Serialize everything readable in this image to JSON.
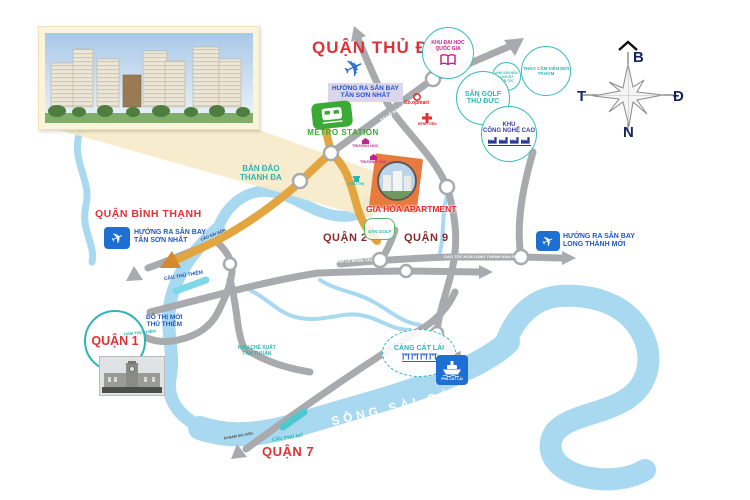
{
  "districts": {
    "thu_duc": "QUẬN THỦ ĐỨC",
    "binh_thanh": "QUẬN BÌNH THẠNH",
    "q1": "QUẬN 1",
    "q2": "QUẬN 2",
    "q9": "QUẬN 9",
    "q7": "QUẬN 7"
  },
  "project": {
    "name": "GIA HÒA APARTMENT",
    "nearby_golf": "SÂN GOLF"
  },
  "airports": {
    "tsn_top": {
      "l1": "HƯỚNG RA SÂN BAY",
      "l2": "TÂN SƠN NHẤT"
    },
    "tsn_left": {
      "l1": "HƯỚNG RA SÂN BAY",
      "l2": "TÂN SƠN NHẤT"
    },
    "long_thanh": {
      "l1": "HƯỚNG RA SÂN BAY",
      "l2": "LONG THÀNH MỚI"
    }
  },
  "pois": {
    "khu_dai_hoc": {
      "l1": "KHU ĐẠI HỌC",
      "l2": "QUỐC GIA"
    },
    "thao_cam_vien": {
      "l1": "THẢO CẦM VIÊN MỚI",
      "l2": "TP.HCM"
    },
    "khu_van_hoa": {
      "l1": "KHU VĂN HÓA",
      "l2": "LỊCH SỬ",
      "l3": "DÂN TỘC"
    },
    "san_golf": {
      "l1": "SÂN GOLF",
      "l2": "THỦ ĐỨC"
    },
    "cong_nghe_cao": {
      "l1": "KHU",
      "l2": "CÔNG NGHỆ CAO"
    },
    "metro": "METRO STATION",
    "thanh_da": {
      "l1": "BÁN ĐẢO",
      "l2": "THANH ĐA"
    },
    "coopmart": "Co.opmart",
    "benh_vien": "BỆNH VIỆN",
    "truong_hoc_1": "TRƯỜNG HỌC",
    "truong_hoc_2": "TRƯỜNG HỌC",
    "sieu_thi": "SIÊU THỊ",
    "do_thi_moi": {
      "l1": "ĐÔ THỊ MỚI",
      "l2": "THỦ THIÊM"
    },
    "ham_thu_thiem": "HẦM THỦ THIÊM",
    "khu_che_xuat": {
      "l1": "KHU CHẾ XUẤT",
      "l2": "TÂN THUẬN"
    },
    "cang_cat_lai": "CẢNG CÁT LÁI",
    "pha_cat_lai": "PHÀ CÁT LÁI"
  },
  "waterways": {
    "song_sai_gon": "SÔNG SÀI GÒN"
  },
  "bridges": {
    "cau_sai_gon": "CẦU SÀI GÒN",
    "cau_thu_thiem": "CẦU THỦ THIÊM",
    "cau_phu_my": "CẦU PHÚ MỸ"
  },
  "roads": {
    "xa_lo_ha_noi": "XA LỘ HÀ NỘI",
    "cao_toc": "CAO TỐC HCM LONG THÀNH DẦU GIÂY",
    "dai_lo_dong_tay": "ĐẠI LỘ ĐÔNG TÂY",
    "di_nam_sai_gon": "ĐI NAM SÀI GÒN"
  },
  "compass": {
    "north": "B",
    "east": "Đ",
    "south": "N",
    "west": "T"
  },
  "colors": {
    "district_red": "#e03236",
    "district_maroon": "#8a2a2c",
    "teal": "#2cb5b2",
    "blue": "#2256c4",
    "magenta": "#c0268f",
    "purple": "#3b3f9e",
    "orange_route": "#e2a53f",
    "project_orange": "#e87a3e",
    "road_gray": "#a8aaad",
    "river_blue": "#a9d9f0",
    "metro_green": "#3aa935",
    "sign_blue": "#1d6fd1"
  }
}
